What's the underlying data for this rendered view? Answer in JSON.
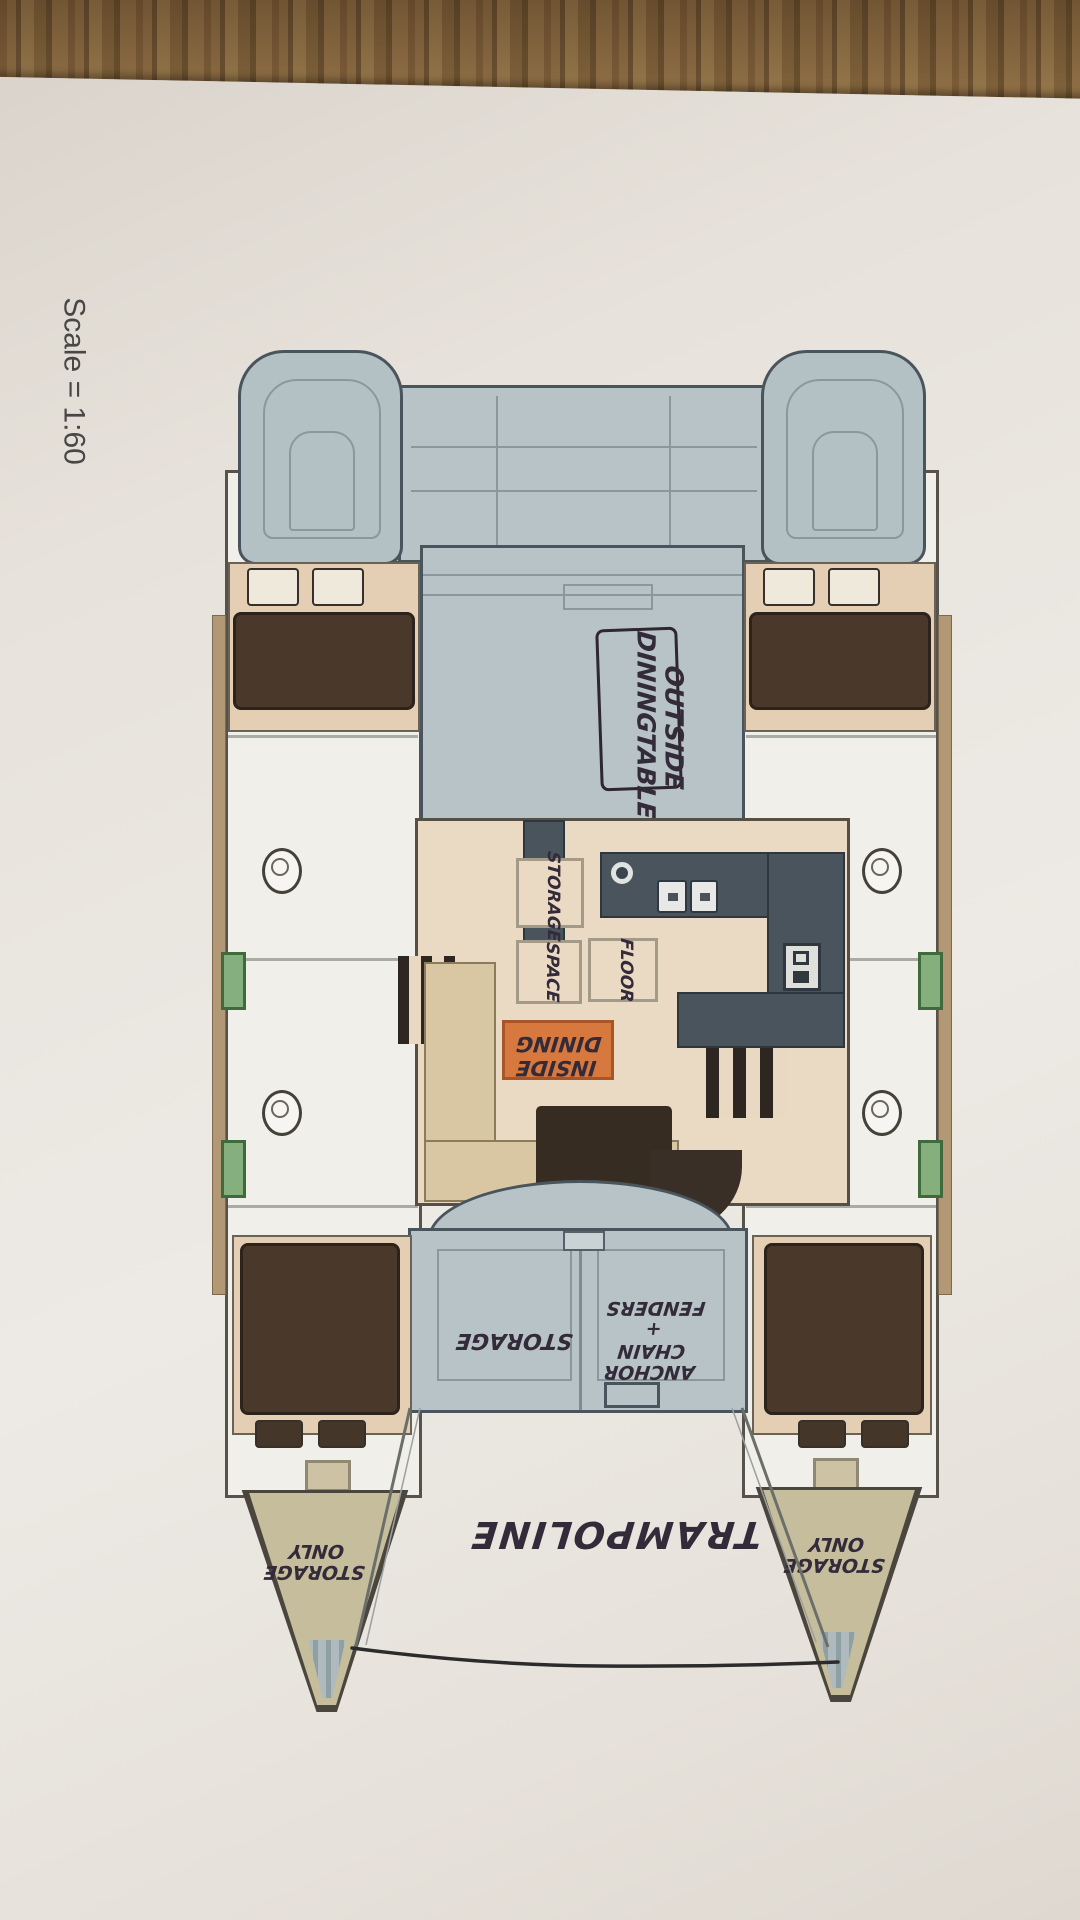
{
  "scale_note": "Scale = 1:60",
  "plan_labels": {
    "outside_dining": [
      "OUTSIDE",
      "DININGTABLE"
    ],
    "storage_hatch": "STORAGE",
    "space_hatch": "SPACE",
    "floor_hatch": "FLOOR",
    "inside_dining": [
      "INSIDE",
      "DINING"
    ],
    "bow_deck_storage": "STORAGE",
    "anchor_locker": [
      "ANCHOR",
      "CHAIN",
      "+",
      "FENDERS"
    ],
    "trampoline": "TRAMPOLINE",
    "port_bow_storage_only": [
      "STORAGE",
      "ONLY"
    ],
    "starboard_bow_storage_only": [
      "STORAGE",
      "ONLY"
    ]
  },
  "colors": {
    "wood_brown": "#81623c",
    "paper": "#e9e4dd",
    "deck_gray_blue": "#b7c3c6",
    "hull_white": "#f1efe9",
    "cabin_tan": "#e4cfb4",
    "bed_brown": "#4a392b",
    "galley_slate": "#49545c",
    "sticker_orange": "#d7793e",
    "bow_khaki": "#c6bd9d",
    "hatch_green": "#85af7d",
    "table_brown": "#362c21",
    "handwriting_ink": "#332b3a"
  }
}
